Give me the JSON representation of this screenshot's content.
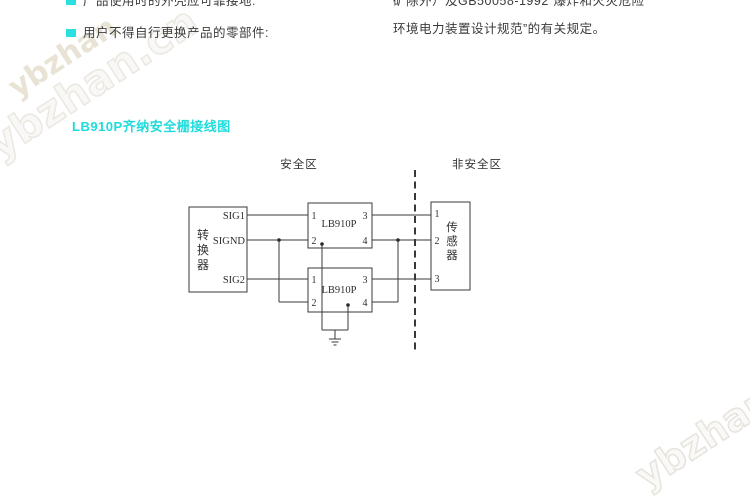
{
  "notes": {
    "left": [
      {
        "text": "产品使用时的外壳应可靠接地:"
      },
      {
        "text": "用户不得自行更换产品的零部件:"
      }
    ],
    "right": [
      {
        "text": "矿除外）及GB50058-1992“爆炸和火灾危险"
      },
      {
        "text": "环境电力装置设计规范”的有关规定。"
      }
    ]
  },
  "heading": {
    "text": "LB910P齐纳安全栅接线图"
  },
  "diagram": {
    "zones": {
      "safe": "安全区",
      "unsafe": "非安全区"
    },
    "converter": {
      "name_chars": [
        "转",
        "换",
        "器"
      ],
      "terminals": [
        "SIG1",
        "SIGND",
        "SIG2"
      ]
    },
    "barriers": [
      {
        "label": "LB910P",
        "pins": [
          "1",
          "3",
          "2",
          "4"
        ]
      },
      {
        "label": "LB910P",
        "pins": [
          "1",
          "3",
          "2",
          "4"
        ]
      }
    ],
    "sensor": {
      "name_chars": [
        "传",
        "感",
        "器"
      ],
      "terminals": [
        "1",
        "2",
        "3"
      ]
    },
    "ground": {
      "symbol_name": "earth-ground"
    }
  },
  "watermark": {
    "site": "ybzhan.cn",
    "site_short": "ybzhan"
  },
  "colors": {
    "accent_cyan": "#1edcdc",
    "body_text": "#3b3b3b",
    "diagram_line": "#3a3a3a",
    "watermark_tan": "#d5ccb2"
  }
}
